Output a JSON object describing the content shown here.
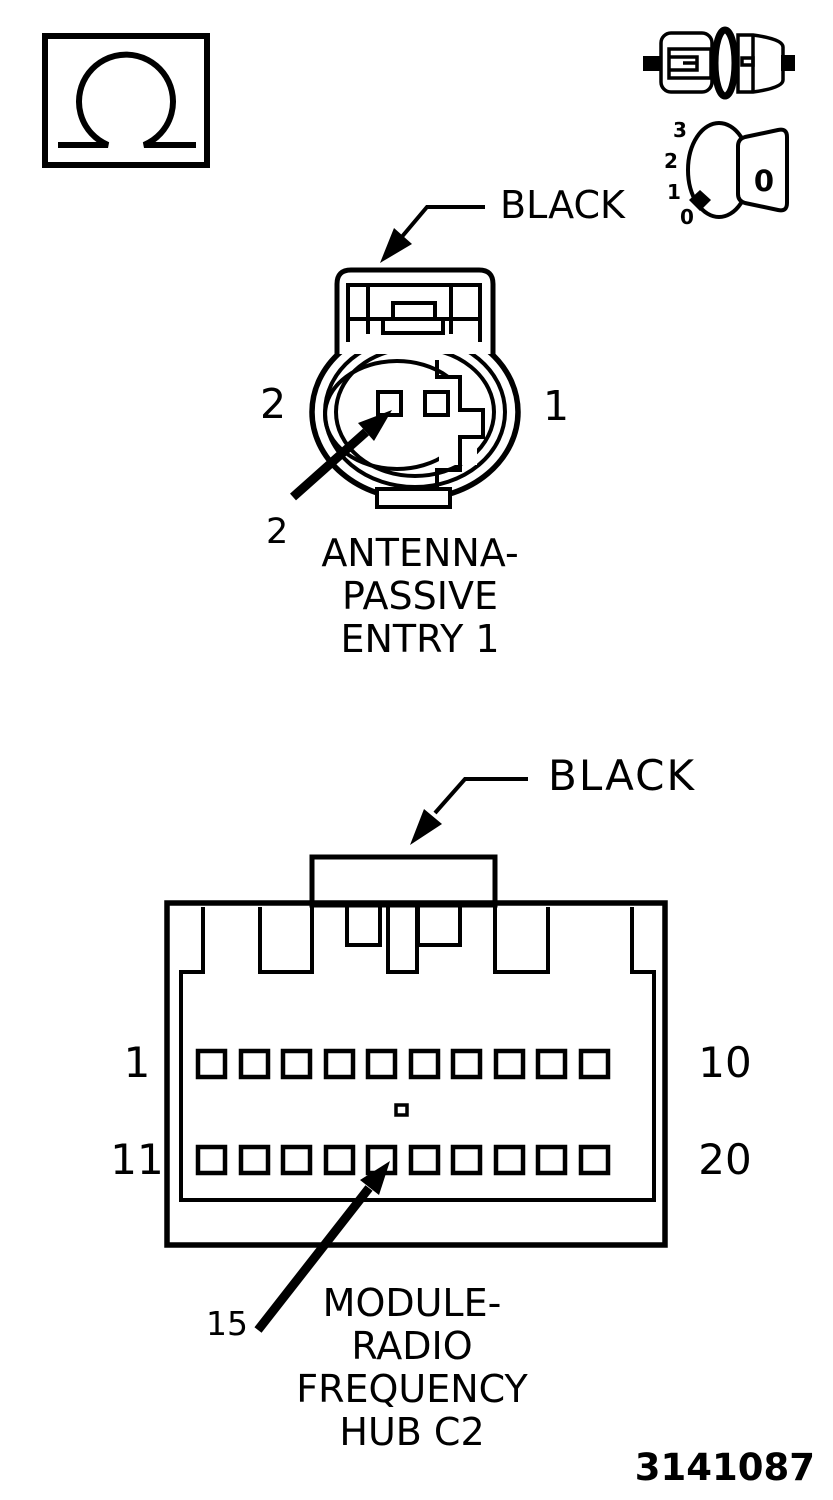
{
  "figure": {
    "number": "3141087"
  },
  "colors": {
    "ink": "#000000",
    "paper": "#ffffff"
  },
  "icons": {
    "ohm_meter": {
      "name": "ohm-meter-icon"
    },
    "disconnect": {
      "name": "connector-disconnect-icon"
    },
    "ignition_off": {
      "name": "ignition-off-icon",
      "positions": [
        "3",
        "2",
        "1",
        "0"
      ],
      "key_label": "0"
    }
  },
  "connector_top": {
    "color_label": "BLACK",
    "pin_left_label": "2",
    "pin_right_label": "1",
    "callout_pin": "2",
    "caption_lines": [
      "ANTENNA-",
      "PASSIVE",
      "ENTRY 1"
    ]
  },
  "connector_bottom": {
    "color_label": "BLACK",
    "row1_left_label": "1",
    "row1_right_label": "10",
    "row2_left_label": "11",
    "row2_right_label": "20",
    "callout_pin": "15",
    "caption_lines": [
      "MODULE-",
      "RADIO",
      "FREQUENCY",
      "HUB C2"
    ]
  }
}
